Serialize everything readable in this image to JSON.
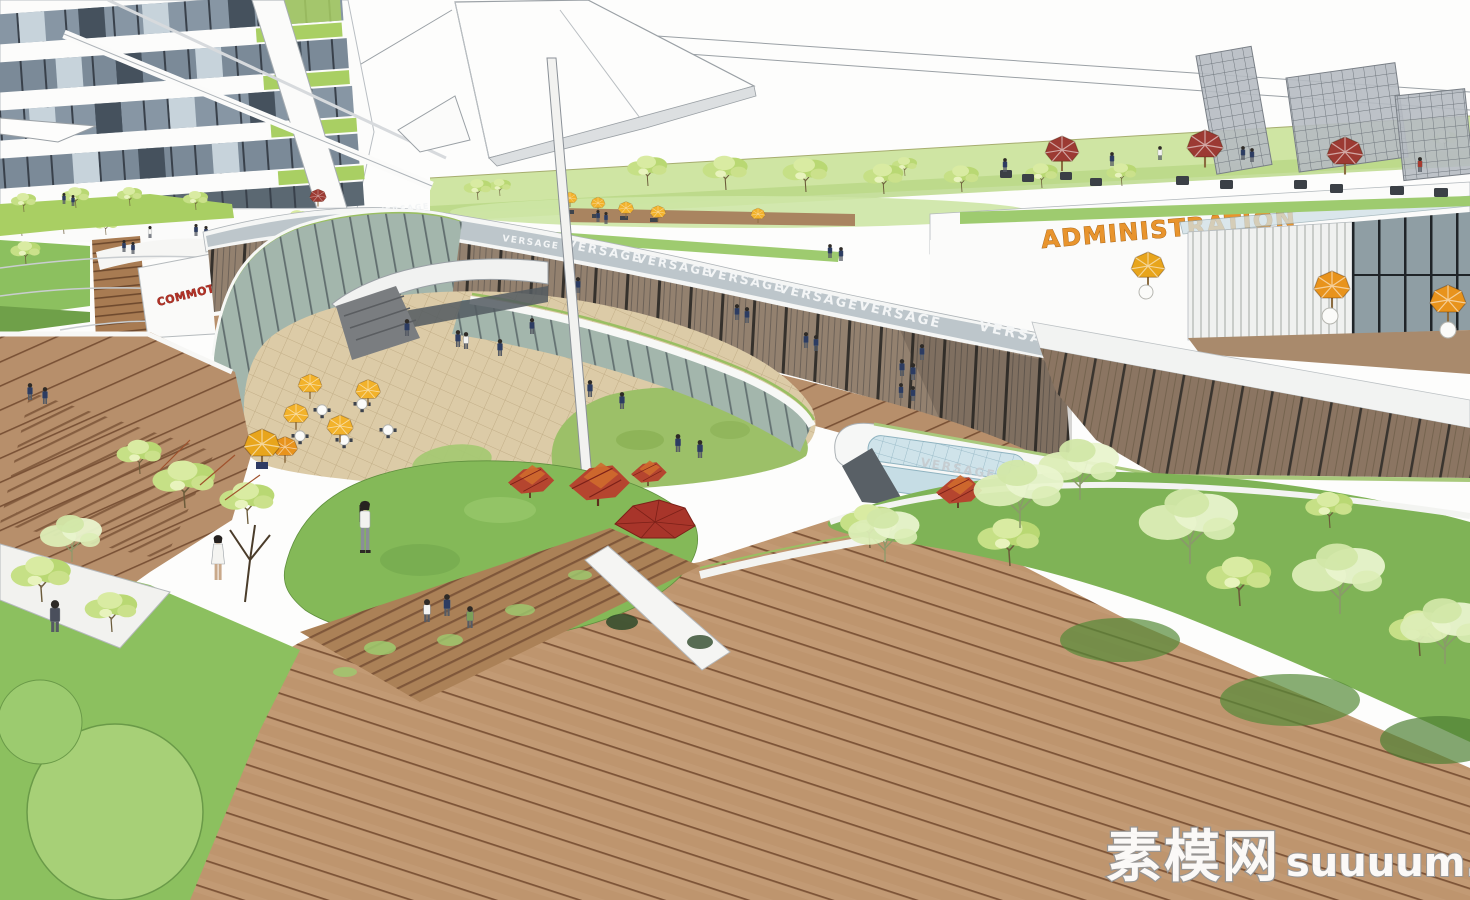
{
  "signs": {
    "mall_fascia_brand": "VERSAGE",
    "administration": "ADMINISTRATION",
    "red_wall_sign": "COMMOTION"
  },
  "watermark": {
    "site_name_cn": "素模网",
    "site_domain": "suuuum.com"
  },
  "palette": {
    "admin_sign_orange": "#E8942D",
    "red_sign": "#B23227",
    "umbrella_yellow": "#F2B22B",
    "umbrella_orange": "#E8931C",
    "umbrella_red": "#9C3A33",
    "lawn_green": "#84B958",
    "deck_wood": "#C29A74",
    "plaza_paving": "#DCCBA7",
    "glass_green": "#A3B6AC",
    "field_green": "#CFE5A3"
  }
}
